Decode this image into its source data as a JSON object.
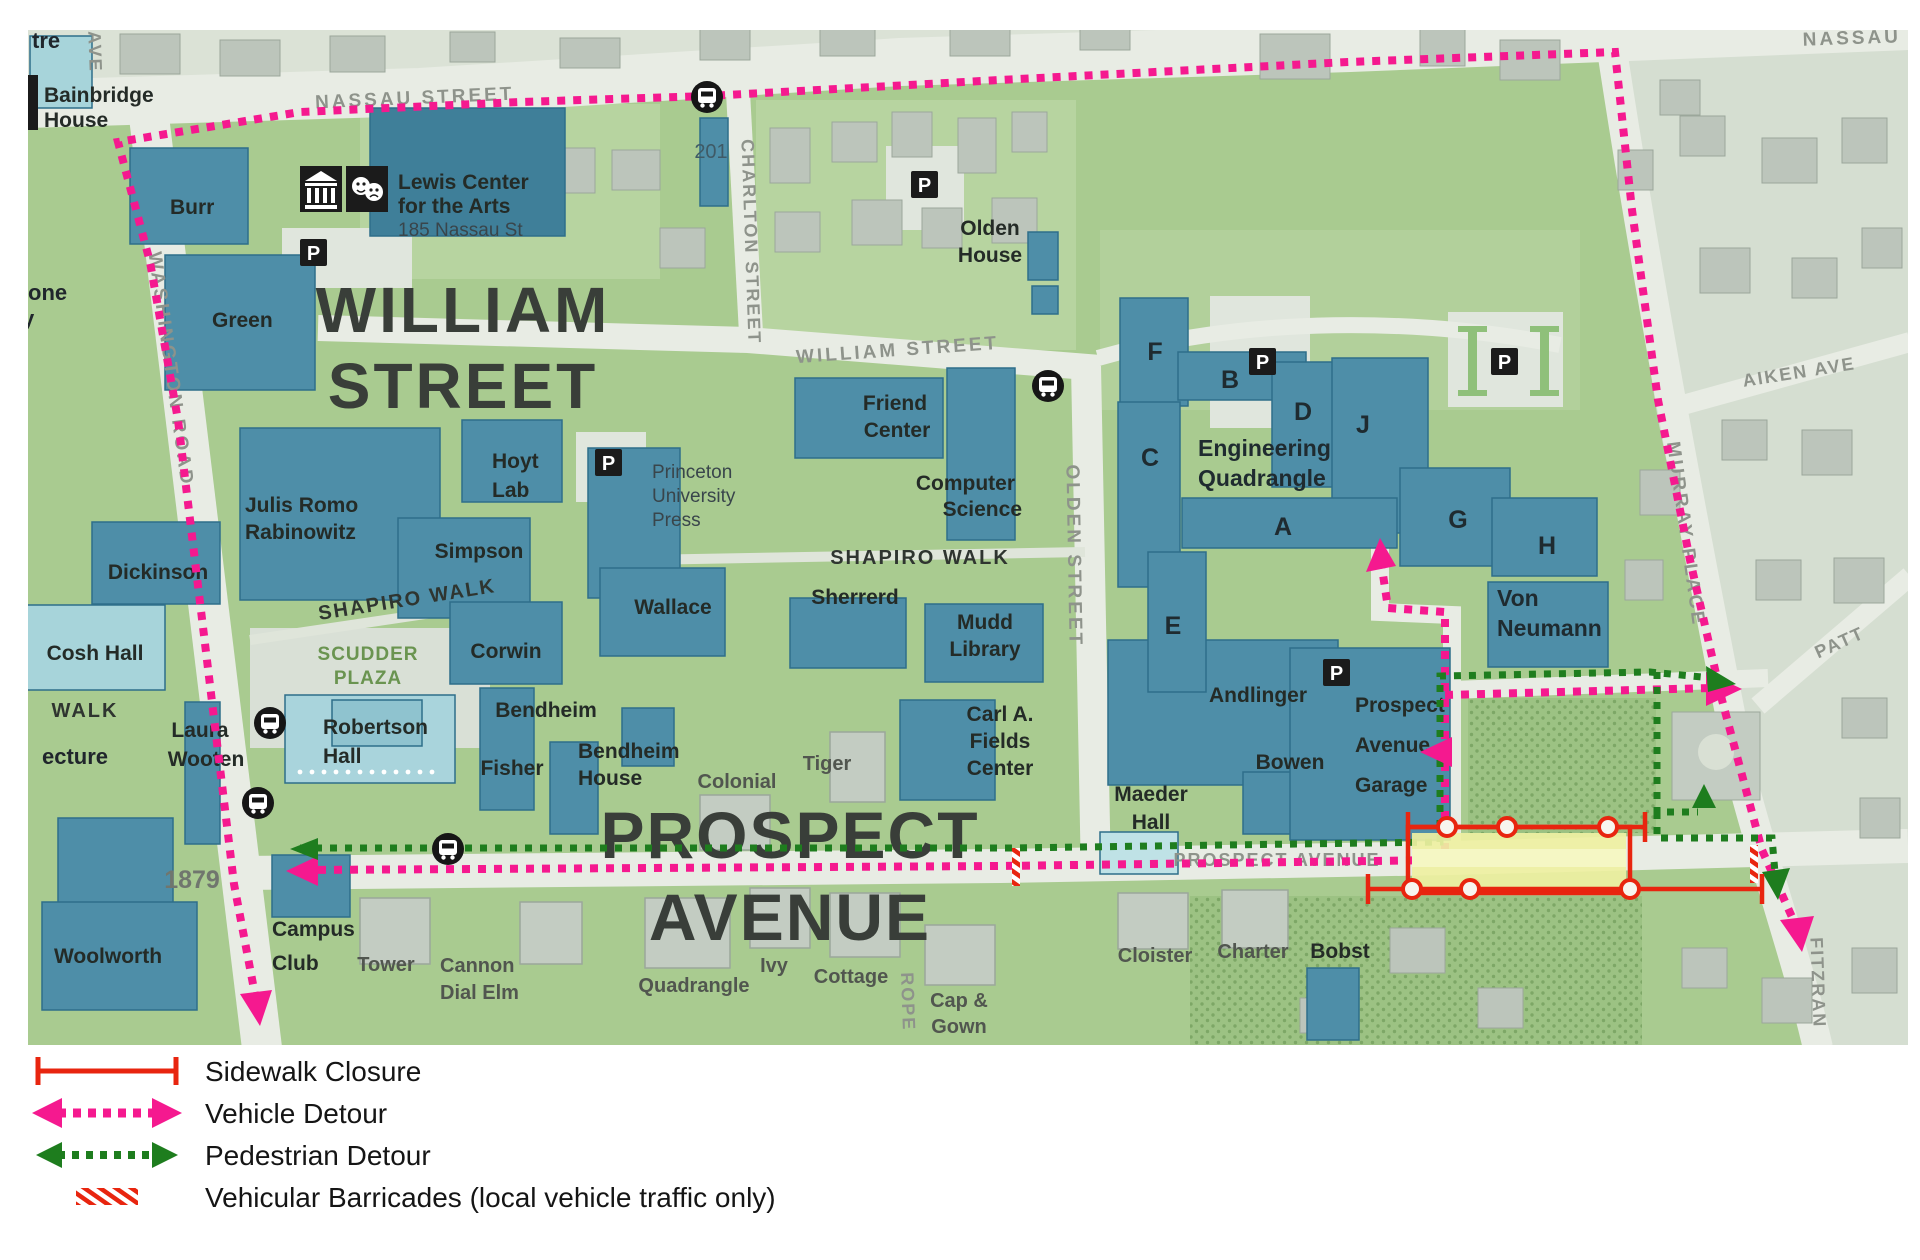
{
  "map": {
    "streets": {
      "nassau": "NASSAU STREET",
      "nassau_east": "NASSAU",
      "william": "WILLIAM STREET",
      "washington": "WASHINGTON ROAD",
      "charlton": "CHARLTON STREET",
      "olden": "OLDEN STREET",
      "murray": "MURRAY PLACE",
      "aiken": "AIKEN AVE",
      "patton": "PATT",
      "fitzrandolph": "FITZRAN",
      "prospect": "PROSPECT AVENUE",
      "ave_partial": "AVE",
      "rope_partial": "ROPE"
    },
    "district_titles": {
      "william_1": "WILLIAM",
      "william_2": "STREET",
      "prospect_1": "PROSPECT",
      "prospect_2": "AVENUE"
    },
    "walks": {
      "shapiro_west": "SHAPIRO WALK",
      "shapiro_east": "SHAPIRO WALK",
      "scudder_1": "SCUDDER",
      "scudder_2": "PLAZA",
      "walk_partial": "WALK",
      "lecture_partial": "ecture",
      "one_partial": "one",
      "y_partial": "y",
      "tre_partial": "tre"
    },
    "buildings": {
      "bainbridge": {
        "l1": "Bainbridge",
        "l2": "House"
      },
      "burr": "Burr",
      "green": "Green",
      "lewis": {
        "l1": "Lewis Center",
        "l2": "for the Arts",
        "l3": "185 Nassau St"
      },
      "b201": "201",
      "olden_house": {
        "l1": "Olden",
        "l2": "House"
      },
      "friend": {
        "l1": "Friend",
        "l2": "Center"
      },
      "computer": {
        "l1": "Computer",
        "l2": "Science"
      },
      "hoyt": {
        "l1": "Hoyt",
        "l2": "Lab"
      },
      "press": {
        "l1": "Princeton",
        "l2": "University",
        "l3": "Press"
      },
      "rabinowitz": {
        "l1": "Julis Romo",
        "l2": "Rabinowitz"
      },
      "simpson": "Simpson",
      "dickinson": "Dickinson",
      "cosh": "Cosh Hall",
      "wooten": {
        "l1": "Laura",
        "l2": "Wooten"
      },
      "robertson": {
        "l1": "Robertson",
        "l2": "Hall"
      },
      "wallace": "Wallace",
      "corwin": "Corwin",
      "bendheim": "Bendheim",
      "fisher": "Fisher",
      "bendheim_house": {
        "l1": "Bendheim",
        "l2": "House"
      },
      "colonial": "Colonial",
      "tiger": "Tiger",
      "sherrerd": "Sherrerd",
      "mudd": {
        "l1": "Mudd",
        "l2": "Library"
      },
      "fields": {
        "l1": "Carl A.",
        "l2": "Fields",
        "l3": "Center"
      },
      "maeder": {
        "l1": "Maeder",
        "l2": "Hall"
      },
      "andlinger": "Andlinger",
      "bowen": "Bowen",
      "garage": {
        "l1": "Prospect",
        "l2": "Avenue",
        "l3": "Garage"
      },
      "von_neumann": {
        "l1": "Von",
        "l2": "Neumann"
      },
      "eng_quad": {
        "l1": "Engineering",
        "l2": "Quadrangle"
      },
      "woolworth": "Woolworth",
      "h1879": "1879",
      "campus_club": {
        "l1": "Campus",
        "l2": "Club"
      },
      "tower": "Tower",
      "cannon": {
        "l1": "Cannon",
        "l2": "Dial Elm"
      },
      "quadrangle": "Quadrangle",
      "ivy": "Ivy",
      "cottage": "Cottage",
      "cap_gown": {
        "l1": "Cap &",
        "l2": "Gown"
      },
      "cloister": "Cloister",
      "charter": "Charter",
      "bobst": "Bobst"
    },
    "eng_units": {
      "a": "A",
      "b": "B",
      "c": "C",
      "d": "D",
      "e": "E",
      "f": "F",
      "g": "G",
      "h": "H",
      "j": "J"
    },
    "icons": {
      "parking": "P"
    }
  },
  "legend": {
    "items": [
      {
        "label": "Sidewalk Closure",
        "type": "sidewalk-closure",
        "color": "#e8250f"
      },
      {
        "label": "Vehicle Detour",
        "type": "vehicle-detour",
        "color": "#f5198f"
      },
      {
        "label": "Pedestrian Detour",
        "type": "pedestrian-detour",
        "color": "#1e7d1e"
      },
      {
        "label": "Vehicular Barricades (local vehicle traffic only)",
        "type": "vehicular-barricades",
        "color": "#e8250f"
      }
    ]
  },
  "colors": {
    "vehicle_detour": "#f5198f",
    "pedestrian_detour": "#1e7d1e",
    "closure": "#e8250f",
    "campus_building": "#4e8ea8",
    "campus_green": "#a9cb90"
  }
}
